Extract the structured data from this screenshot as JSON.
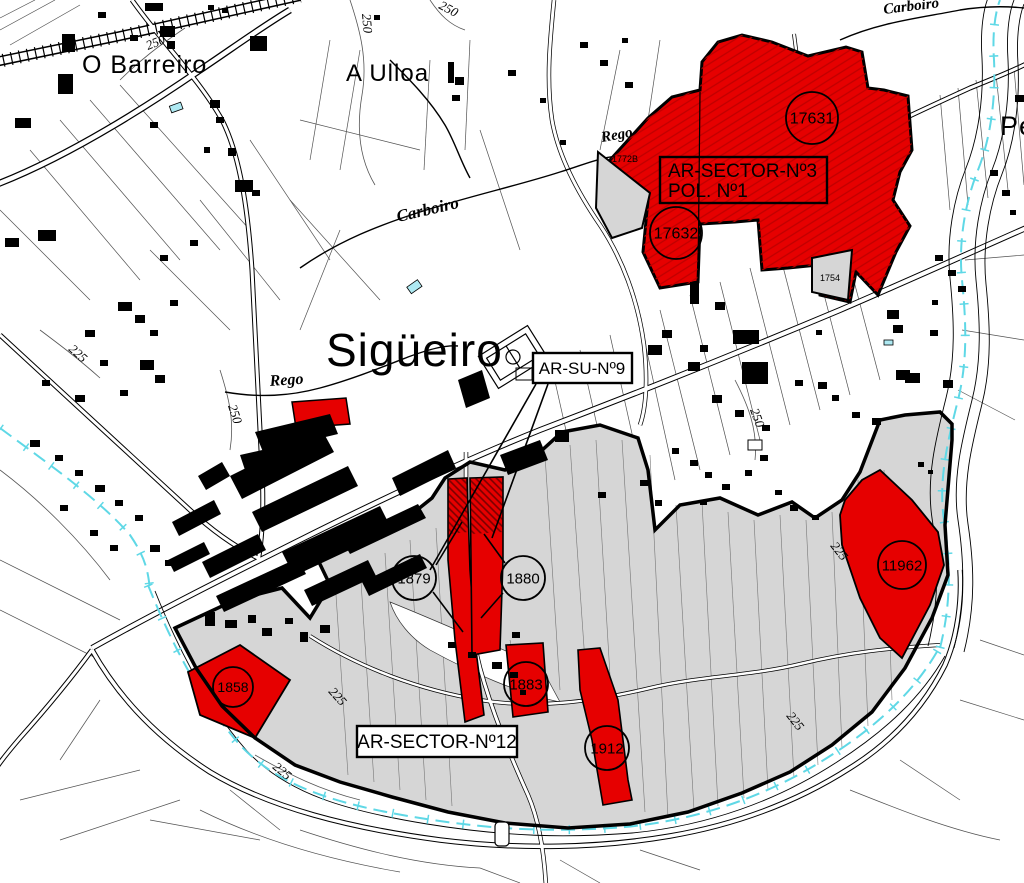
{
  "title": "Sigüeiro",
  "places": {
    "o_barreiro": "O Barreiro",
    "a_ulloa": "A Ulloa",
    "sigueiro": "Sigüeiro",
    "pe_edge": "Pe"
  },
  "streams": {
    "carboiro": "Carboiro",
    "rego": "Rego"
  },
  "sector_boxes": {
    "s3_line1": "AR-SECTOR-Nº3",
    "s3_line2": "POL. Nº1",
    "su9": "AR-SU-Nº9",
    "s12": "AR-SECTOR-Nº12"
  },
  "parcel_circles": {
    "c17631": "17631",
    "c17632": "17632",
    "c11962": "11962",
    "c1879": "1879",
    "c1880": "1880",
    "c1858": "1858",
    "c1883": "1883",
    "c1912": "1912"
  },
  "small_parcels": {
    "p1772b": "1772B",
    "p1754": "1754"
  },
  "contours": {
    "c250": "250",
    "c225": "225"
  },
  "colors": {
    "parcel_red": "#e60000",
    "sector_gray": "#d6d6d6",
    "water_cyan": "#5fd8e6",
    "line_black": "#000000"
  }
}
